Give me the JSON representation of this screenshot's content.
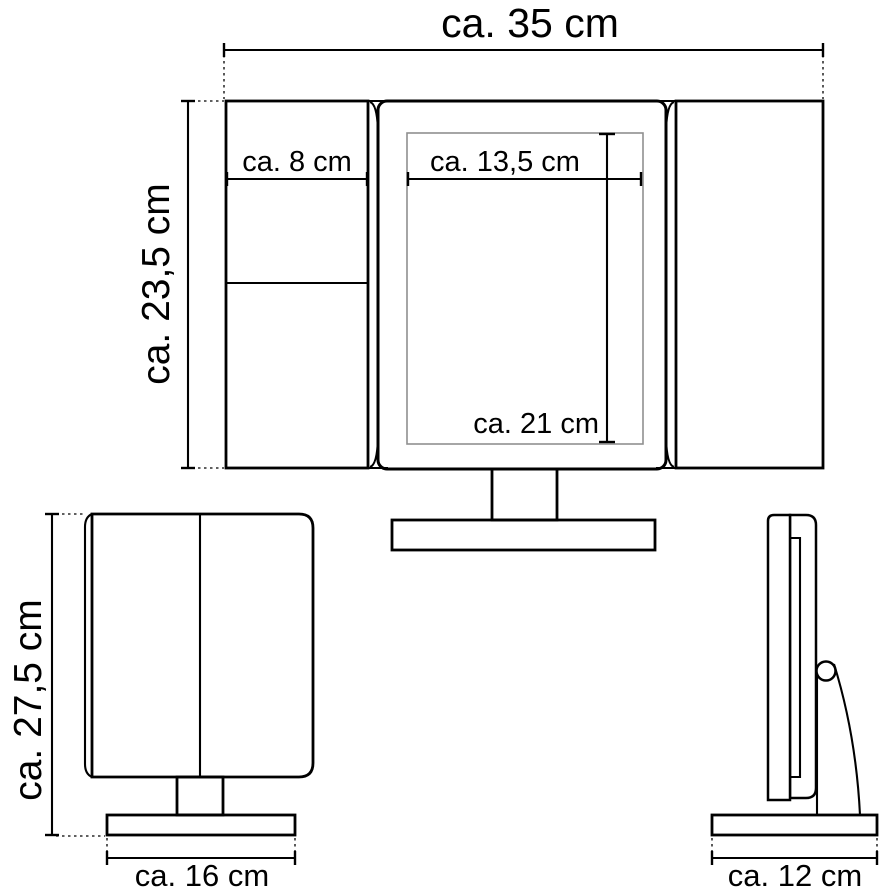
{
  "colors": {
    "line": "#000000",
    "inner_mirror_line": "#8f8f8f",
    "background": "#ffffff"
  },
  "front_view": {
    "overall_width": {
      "label": "ca. 35 cm",
      "value_cm": 35
    },
    "overall_height": {
      "label": "ca. 23,5 cm",
      "value_cm": 23.5
    },
    "left_panel_width": {
      "label": "ca. 8 cm",
      "value_cm": 8
    },
    "mirror_width": {
      "label": "ca. 13,5 cm",
      "value_cm": 13.5
    },
    "mirror_height": {
      "label": "ca. 21 cm",
      "value_cm": 21
    }
  },
  "folded_view": {
    "overall_height": {
      "label": "ca. 27,5 cm",
      "value_cm": 27.5
    },
    "base_width": {
      "label": "ca. 16 cm",
      "value_cm": 16
    }
  },
  "side_view": {
    "base_depth": {
      "label": "ca. 12 cm",
      "value_cm": 12
    }
  }
}
